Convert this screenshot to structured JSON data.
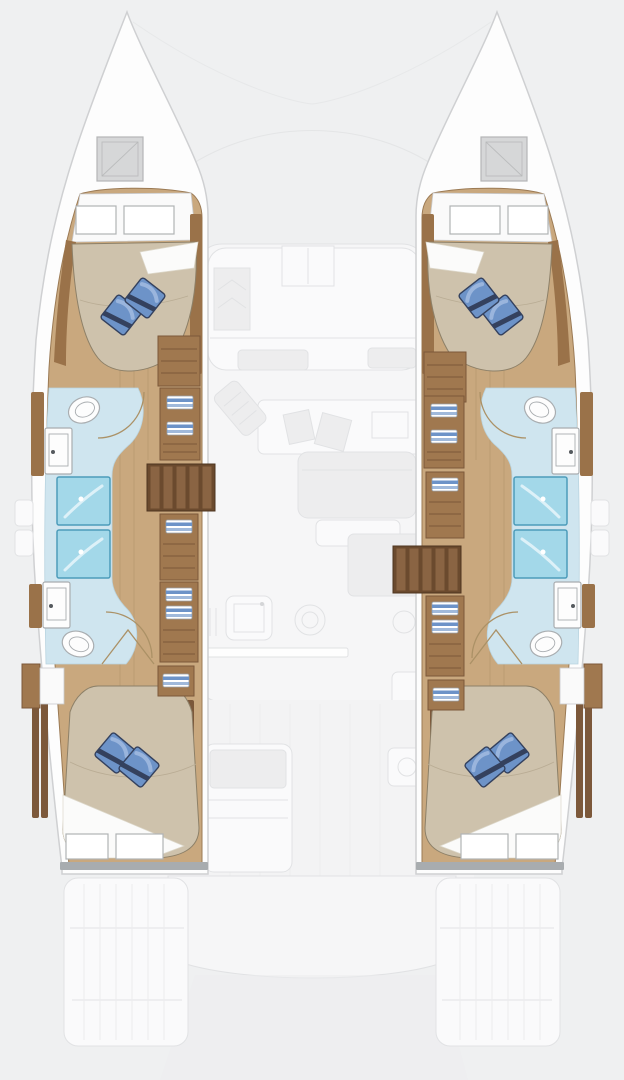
{
  "palette": {
    "background": "#eff0f1",
    "deck_fill": "#f6f6f7",
    "deck_line": "#e1e2e4",
    "deck_soft": "#ededee",
    "ghost_fill": "#fafafb",
    "hull_white": "#fdfdfd",
    "hull_line": "#cfd0d2",
    "wood": "#c9a87e",
    "wood_line": "#9b7a54",
    "trim": "#9a7249",
    "dark_wood": "#7c583a",
    "cabinet": "#a0784f",
    "cabinet_line": "#7c583a",
    "stairs_base": "#6b4a2e",
    "stairs_step": "#8a6443",
    "bed": "#cec2ac",
    "bed_line": "#8d8068",
    "bed_shade": "#b9ac94",
    "sheet": "#fbfbfa",
    "band_white": "#fafafa",
    "pillow": "#6d93c8",
    "pillow_hi": "#9ab5dd",
    "pillow_dark": "#34415e",
    "bath_floor": "#cfe5ef",
    "bath_line": "#b9d4e0",
    "shower": "#a3d8e9",
    "shower_line": "#4d9cba",
    "fixture": "#fdfdfd",
    "fixture_line": "#a9adb0",
    "arc": "#ab9166",
    "window_line": "#b0b3b5",
    "transom": "#a8acaf",
    "hatch": "#d6d7d8",
    "hatch_line": "#b4b5b7"
  },
  "floorplan": {
    "vessel": "sailing-catamaran",
    "view": "top-down-deck-plan",
    "orientation": "bow-up",
    "highlighted_deck": "hull-accommodation-level",
    "faded_deck": "main-deck-saloon-and-cockpits",
    "hulls": [
      {
        "id": "left-hull",
        "spaces": [
          "forward-double-cabin",
          "forward-head-with-shower",
          "companionway-stairs",
          "storage-cabinets",
          "aft-head-with-shower",
          "aft-double-cabin"
        ]
      },
      {
        "id": "right-hull",
        "spaces": [
          "forward-double-cabin",
          "forward-head-with-shower",
          "storage-cabinets",
          "companionway-stairs",
          "aft-head-with-shower",
          "aft-double-cabin"
        ]
      }
    ],
    "main_deck_faded_features": [
      "bow-trampoline-lines",
      "forward-cockpit-seating",
      "forward-cockpit-table",
      "saloon-sofa",
      "chart-seat",
      "galley-sink",
      "galley-stove",
      "galley-counter",
      "aft-cockpit-sofa",
      "aft-cockpit-module",
      "aft-bench",
      "swim-platform",
      "stern-steps"
    ],
    "counts": {
      "double_berths": 4,
      "toilets": 4,
      "showers": 4,
      "sinks": 4,
      "pillows": 8,
      "bow_hatches": 2,
      "stair_flights": 2
    }
  }
}
